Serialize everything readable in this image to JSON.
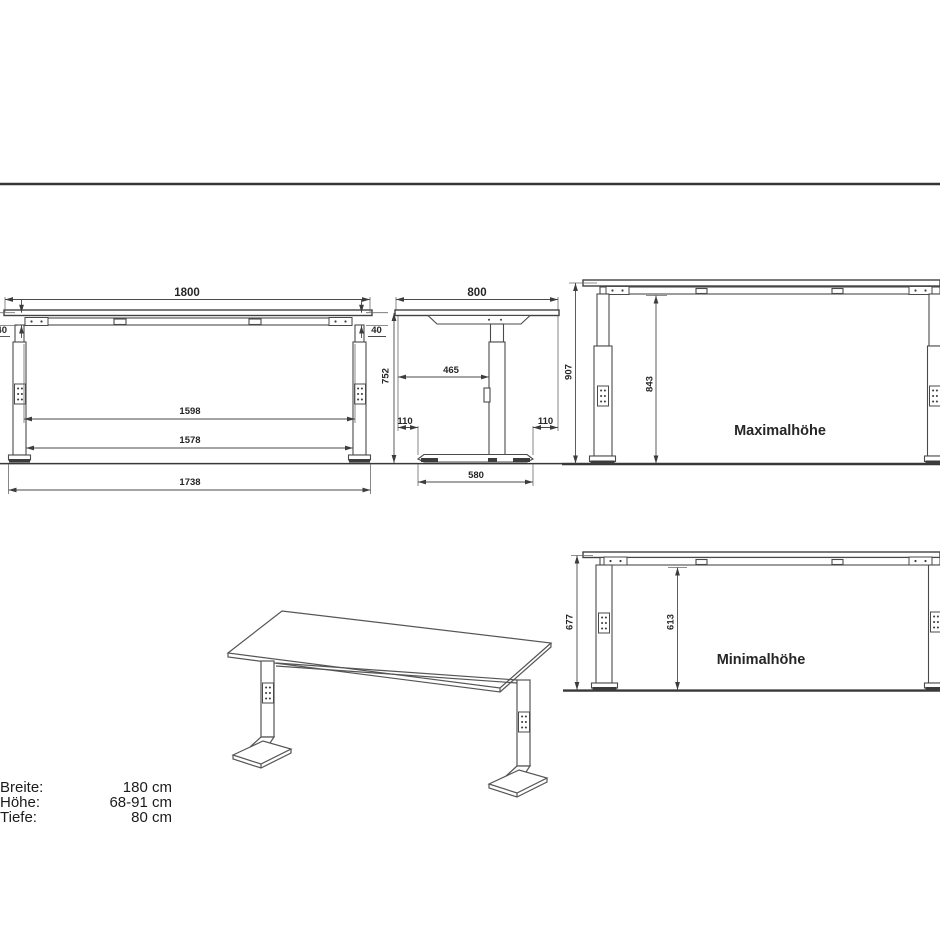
{
  "drawing": {
    "front": {
      "dim_width": "1800",
      "dim_thick_left": "40",
      "dim_thick_right": "40",
      "dim_height": "752",
      "dim_inner_upper": "1598",
      "dim_inner_lower": "1578",
      "dim_feet": "1738"
    },
    "side": {
      "dim_depth": "800",
      "dim_offset": "465",
      "dim_overhang_left": "110",
      "dim_overhang_right": "110",
      "dim_base": "580"
    },
    "max_view": {
      "dim_total": "907",
      "dim_clear": "843",
      "label": "Maximalhöhe"
    },
    "min_view": {
      "dim_total": "677",
      "dim_clear": "613",
      "label": "Minimalhöhe"
    },
    "specs": {
      "rows": [
        {
          "label": "Breite:",
          "value": "180 cm"
        },
        {
          "label": "Höhe:",
          "value": "68-91 cm"
        },
        {
          "label": "Tiefe:",
          "value": "80 cm"
        }
      ]
    }
  }
}
